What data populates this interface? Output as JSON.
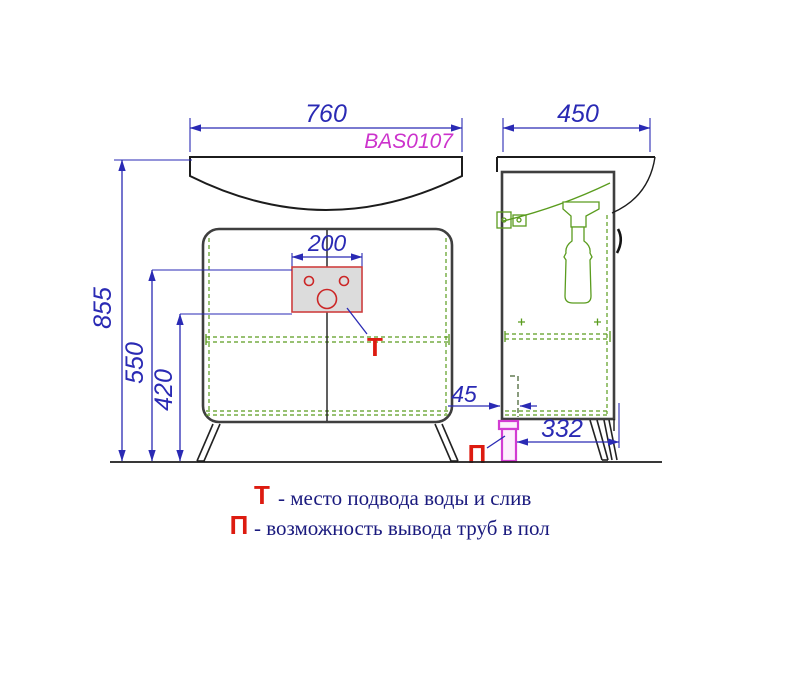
{
  "drawing": {
    "model_code": "BAS0107",
    "dimensions": {
      "front_width": "760",
      "side_depth": "450",
      "tap_cutout_width": "200",
      "height_total": "855",
      "height_water_supply": "550",
      "height_water_bottom": "420",
      "pipe_wall_offset": "45",
      "pipe_floor_span": "332"
    },
    "markers": {
      "water_supply": "Т",
      "floor_pipe": "П"
    },
    "legend": {
      "items": [
        {
          "marker": "Т",
          "text": "- место подвода воды и слив"
        },
        {
          "marker": "П",
          "text": "- возможность вывода труб в пол"
        }
      ]
    },
    "colors": {
      "dimension_blue": "#2a2ab4",
      "model_magenta": "#cc33cc",
      "marker_red": "#dd1b10",
      "fitting_green": "#5a9c1e",
      "outline_black": "#1c1c1c",
      "legend_navy": "#1a1a7e",
      "pipe_magenta": "#d23cd2",
      "panel_gray": "#dcdcdc"
    }
  }
}
